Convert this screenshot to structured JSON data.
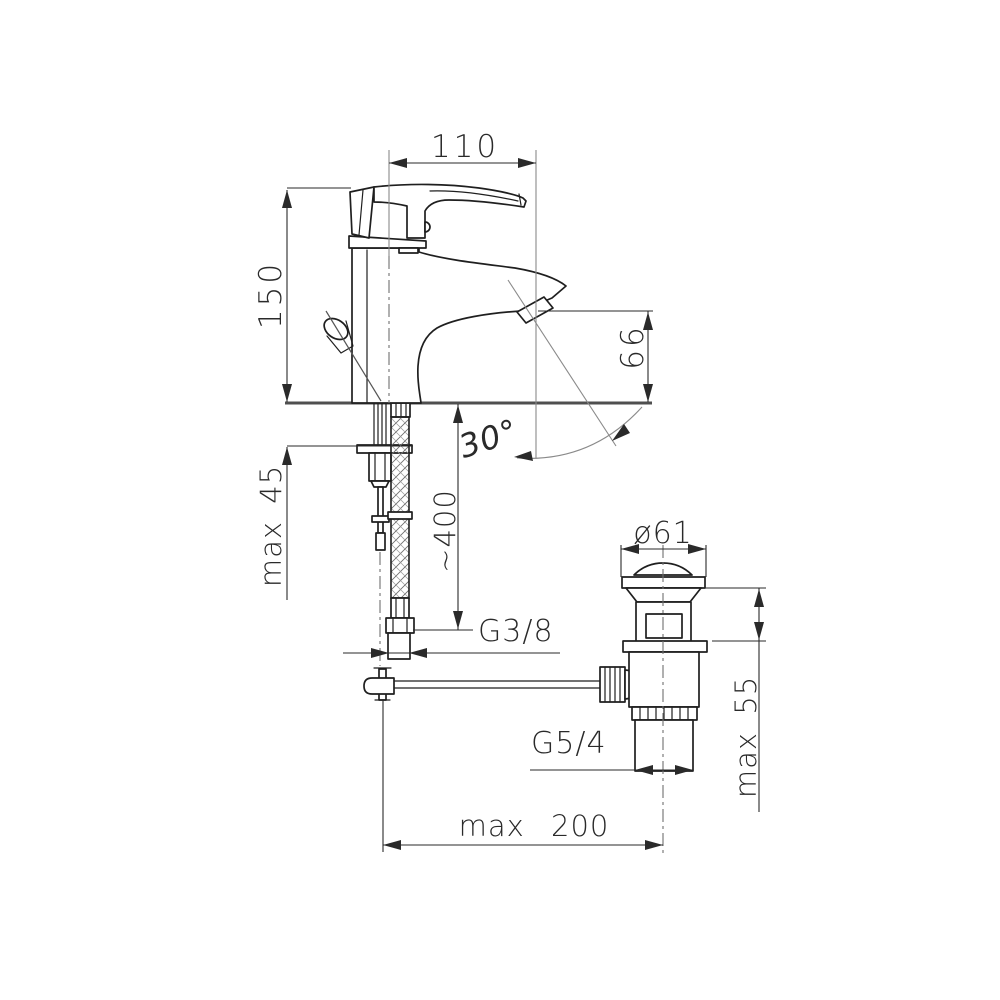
{
  "drawing": {
    "type": "technical-dimension-drawing",
    "subject": "single-lever basin mixer faucet with flexible supply hose and pop-up waste",
    "units": "mm",
    "labels": {
      "spout_reach": "110",
      "body_height": "150",
      "spout_height": "66",
      "spray_angle": "30°",
      "deck_thickness": "max 45",
      "hose_length": "~400",
      "supply_thread": "G3/8",
      "waste_cap_diameter": "ø61",
      "waste_outlet_thread": "G5/4",
      "basin_thickness": "max 55",
      "rod_reach": "max 200"
    },
    "colors": {
      "background": "#ffffff",
      "outline": "#1f1f1f",
      "dimension": "#2a2a2a",
      "construction": "#8a8a8a",
      "deck": "#4f4f4f"
    }
  }
}
